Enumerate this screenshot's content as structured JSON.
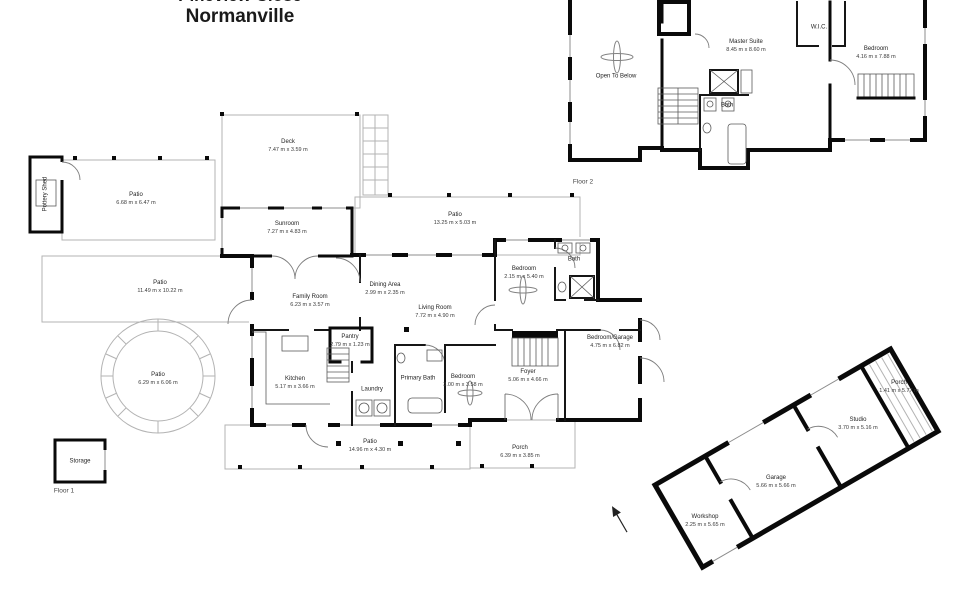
{
  "header": {
    "address_line1": "Pineview Close",
    "address_line2": "Normanville"
  },
  "floors": {
    "floor2": {
      "label": "Floor 2",
      "rooms": {
        "open_to_below": {
          "name": "Open To Below",
          "dims": ""
        },
        "master_suite": {
          "name": "Master Suite",
          "dims": "8.45 m x 8.60 m"
        },
        "wic": {
          "name": "W.I.C.",
          "dims": ""
        },
        "bath": {
          "name": "Bath",
          "dims": ""
        },
        "bedroom": {
          "name": "Bedroom",
          "dims": "4.16 m x 7.88 m"
        }
      }
    },
    "floor1": {
      "label": "Floor 1",
      "rooms": {
        "pottery_shed": {
          "name": "Pottery Shed",
          "dims": ""
        },
        "patio_nw": {
          "name": "Patio",
          "dims": "6.68 m x 6.47 m"
        },
        "deck": {
          "name": "Deck",
          "dims": "7.47 m x 3.59 m"
        },
        "sunroom": {
          "name": "Sunroom",
          "dims": "7.27 m x 4.83 m"
        },
        "patio_ne": {
          "name": "Patio",
          "dims": "13.25 m x 5.03 m"
        },
        "patio_w": {
          "name": "Patio",
          "dims": "11.49 m x 10.22 m"
        },
        "family_room": {
          "name": "Family Room",
          "dims": "6.23 m x 3.57 m"
        },
        "dining_area": {
          "name": "Dining Area",
          "dims": "2.99 m x 2.35 m"
        },
        "living_room": {
          "name": "Living Room",
          "dims": "7.72 m x 4.90 m"
        },
        "bedroom_n": {
          "name": "Bedroom",
          "dims": "2.15 m x 5.40 m"
        },
        "bath": {
          "name": "Bath",
          "dims": ""
        },
        "pantry": {
          "name": "Pantry",
          "dims": "2.79 m x 1.23 m"
        },
        "kitchen": {
          "name": "Kitchen",
          "dims": "5.17 m x 3.66 m"
        },
        "laundry": {
          "name": "Laundry",
          "dims": ""
        },
        "primary_bath": {
          "name": "Primary Bath",
          "dims": ""
        },
        "bedroom_s": {
          "name": "Bedroom",
          "dims": "3.00 m x 3.58 m"
        },
        "foyer": {
          "name": "Foyer",
          "dims": "5.06 m x 4.66 m"
        },
        "bedroom_garage": {
          "name": "Bedroom/Garage",
          "dims": "4.75 m x 6.82 m"
        },
        "patio_round": {
          "name": "Patio",
          "dims": "6.29 m x 6.06 m"
        },
        "patio_s": {
          "name": "Patio",
          "dims": "14.96 m x 4.30 m"
        },
        "porch": {
          "name": "Porch",
          "dims": "6.39 m x 3.85 m"
        },
        "storage": {
          "name": "Storage",
          "dims": ""
        }
      }
    }
  },
  "outbuilding": {
    "rooms": {
      "workshop": {
        "name": "Workshop",
        "dims": "2.25 m x 5.65 m"
      },
      "garage": {
        "name": "Garage",
        "dims": "5.66 m x 5.66 m"
      },
      "studio": {
        "name": "Studio",
        "dims": "3.70 m x 5.16 m"
      },
      "porch": {
        "name": "Porch",
        "dims": "1.41 m x 5.77 m"
      }
    }
  },
  "colors": {
    "wall": "#0a0a0a",
    "patio_line": "#b3b3b3",
    "text": "#242424"
  }
}
